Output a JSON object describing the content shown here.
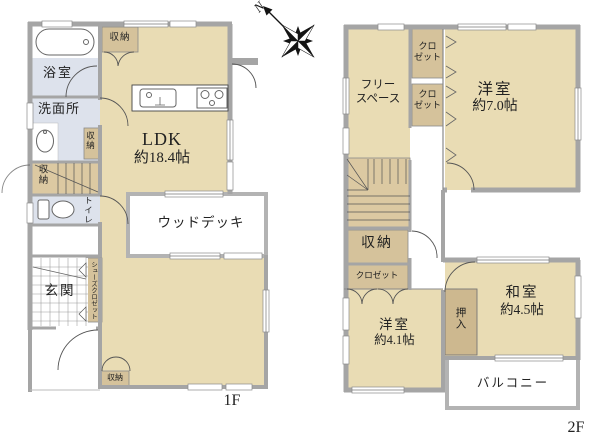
{
  "compass": {
    "north_label": "N"
  },
  "floor1": {
    "floor_label": "1F",
    "rooms": {
      "bath": "浴室",
      "storage_top": "収納",
      "washroom": "洗面所",
      "storage_mid": "収納",
      "storage_stairs": "収納",
      "toilet": "トイレ",
      "ldk_name": "LDK",
      "ldk_size": "約18.4帖",
      "wood_deck": "ウッドデッキ",
      "entrance": "玄関",
      "shoe_closet": "シューズクロゼット",
      "storage_bottom": "収納"
    }
  },
  "floor2": {
    "floor_label": "2F",
    "rooms": {
      "free_space_line1": "フリー",
      "free_space_line2": "スペース",
      "closet1_line1": "クロ",
      "closet1_line2": "ゼット",
      "closet2_line1": "クロ",
      "closet2_line2": "ゼット",
      "western7_name": "洋室",
      "western7_size": "約7.0帖",
      "storage": "収納",
      "closet_lower": "クロゼット",
      "western41_name": "洋室",
      "western41_size": "約4.1帖",
      "oshiire": "押入",
      "washitsu_name": "和室",
      "washitsu_size": "約4.5帖",
      "balcony": "バルコニー"
    }
  },
  "colors": {
    "room_fill": "#e9dcb4",
    "closet_fill": "#d5c29b",
    "stair_fill": "#dcc9a2",
    "oshiire_fill": "#cdb88f",
    "wet_area_fill": "#dde2ec",
    "wall": "#a5a5a5",
    "outdoor_border": "#b3b3b3"
  }
}
